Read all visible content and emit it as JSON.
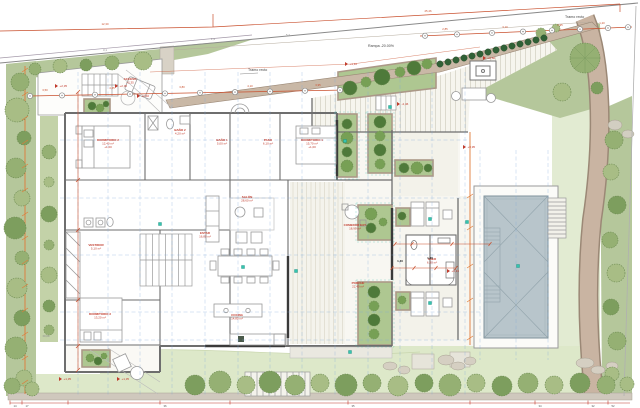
{
  "plan": {
    "annotations": {
      "tramo_recto_top": "Tramo recto",
      "tramo_recto_mid": "Tramo recto",
      "ramp": "Rampa -20.00%",
      "stair_note": "±0,00"
    },
    "colors": {
      "green": "#b5c79b",
      "green_light": "#c3d2a8",
      "lawn": "#dde8c9",
      "lawn_light": "#e2ebd2",
      "pool_water": "#b8c5cb",
      "path_tan": "#c9b4a2",
      "wall_tan": "#c9b8a6",
      "dim_red": "#c9502e",
      "dim_orange": "#e07b39",
      "axis_blue": "#7fa8d8",
      "teal": "#35c4b0",
      "tree_dark": "#4e7a3a",
      "wall_gray": "#6e6e6e"
    },
    "room_labels": [
      {
        "x": 108,
        "y": 141,
        "lines": [
          "DORMITORIO 2",
          "12,40 m²",
          "+1,00"
        ]
      },
      {
        "x": 180,
        "y": 131,
        "lines": [
          "BAÑO 2",
          "4,20 m²"
        ]
      },
      {
        "x": 222,
        "y": 141,
        "lines": [
          "BAÑO 1",
          "5,00 m²"
        ]
      },
      {
        "x": 268,
        "y": 141,
        "lines": [
          "PASO",
          "6,10 m²"
        ]
      },
      {
        "x": 312,
        "y": 141,
        "lines": [
          "DORMITORIO 1",
          "15,70 m²",
          "+1,00"
        ]
      },
      {
        "x": 96,
        "y": 246,
        "lines": [
          "VESTIDOR",
          "5,10 m²"
        ]
      },
      {
        "x": 100,
        "y": 315,
        "lines": [
          "DORMITORIO 3",
          "13,20 m²"
        ]
      },
      {
        "x": 247,
        "y": 198,
        "lines": [
          "SALÓN",
          "28,60 m²"
        ]
      },
      {
        "x": 205,
        "y": 234,
        "lines": [
          "ESTAR",
          "16,80 m²"
        ]
      },
      {
        "x": 237,
        "y": 316,
        "lines": [
          "COCINA",
          "14,80 m²"
        ]
      },
      {
        "x": 355,
        "y": 226,
        "lines": [
          "COMEDOR EXT.",
          "18,90 m²"
        ]
      },
      {
        "x": 358,
        "y": 284,
        "lines": [
          "PORCHE",
          "22,40 m²"
        ]
      },
      {
        "x": 432,
        "y": 260,
        "lines": [
          "ASEO",
          "6,30 m²"
        ]
      },
      {
        "x": 130,
        "y": 80,
        "lines": [
          "ACCESO",
          "+2,35"
        ]
      }
    ],
    "level_markers": [
      {
        "x": 58,
        "y": 86,
        "text": "+2,35"
      },
      {
        "x": 118,
        "y": 86,
        "text": "+2,35"
      },
      {
        "x": 140,
        "y": 96,
        "text": "+2,40"
      },
      {
        "x": 348,
        "y": 64,
        "text": "+1,10"
      },
      {
        "x": 400,
        "y": 104,
        "text": "-2,46"
      },
      {
        "x": 62,
        "y": 379,
        "text": "+1,35"
      },
      {
        "x": 120,
        "y": 379,
        "text": "+1,35"
      },
      {
        "x": 450,
        "y": 271,
        "text": "+0,15"
      },
      {
        "x": 466,
        "y": 147,
        "text": "+0,95"
      },
      {
        "x": 486,
        "y": 58,
        "text": "+0,60"
      }
    ],
    "dim_labels": {
      "red": [
        {
          "x": 428,
          "y": 12,
          "t": "25,46"
        },
        {
          "x": 105,
          "y": 25,
          "t": "12,30"
        },
        {
          "x": 45,
          "y": 91,
          "t": "3,50"
        },
        {
          "x": 112,
          "y": 89,
          "t": "4,25"
        },
        {
          "x": 182,
          "y": 88,
          "t": "3,80"
        },
        {
          "x": 250,
          "y": 87,
          "t": "4,10"
        },
        {
          "x": 318,
          "y": 86,
          "t": "3,95"
        },
        {
          "x": 445,
          "y": 30,
          "t": "2,85"
        },
        {
          "x": 505,
          "y": 28,
          "t": "3,10"
        },
        {
          "x": 560,
          "y": 26,
          "t": "2,95"
        },
        {
          "x": 602,
          "y": 24,
          "t": "1,20"
        }
      ],
      "black": [
        {
          "x": 400,
          "y": 262,
          "t": "1,40"
        },
        {
          "x": 430,
          "y": 259,
          "t": "1,20"
        }
      ],
      "gray": [
        {
          "x": 213,
          "y": 40,
          "t": "1,4"
        },
        {
          "x": 288,
          "y": 36,
          "t": "5,2"
        },
        {
          "x": 105,
          "y": 51,
          "t": "3,1"
        }
      ]
    },
    "bottom_scale": [
      {
        "x": 10,
        "t": "14"
      },
      {
        "x": 22,
        "t": "17"
      },
      {
        "x": 160,
        "t": "36"
      },
      {
        "x": 348,
        "t": "35"
      },
      {
        "x": 535,
        "t": "34"
      },
      {
        "x": 588,
        "t": "32"
      },
      {
        "x": 608,
        "t": "52"
      }
    ],
    "trees": {
      "left_strip": [
        [
          20,
          82,
          9
        ],
        [
          17,
          110,
          12
        ],
        [
          24,
          138,
          7
        ],
        [
          16,
          168,
          10
        ],
        [
          22,
          198,
          8
        ],
        [
          15,
          228,
          11
        ],
        [
          22,
          258,
          7
        ],
        [
          17,
          288,
          10
        ],
        [
          22,
          318,
          8
        ],
        [
          16,
          348,
          11
        ],
        [
          24,
          378,
          8
        ]
      ],
      "narrow_strip": [
        [
          49,
          152,
          7
        ],
        [
          49,
          182,
          5
        ],
        [
          49,
          214,
          8
        ],
        [
          49,
          245,
          5
        ],
        [
          49,
          275,
          8
        ],
        [
          49,
          306,
          6
        ],
        [
          49,
          330,
          5
        ]
      ],
      "top_band": [
        [
          35,
          69,
          6
        ],
        [
          60,
          66,
          7
        ],
        [
          86,
          65,
          6
        ],
        [
          112,
          63,
          7
        ],
        [
          143,
          61,
          9
        ]
      ],
      "upper_planter": [
        [
          350,
          88,
          7
        ],
        [
          366,
          82,
          5
        ],
        [
          382,
          77,
          8
        ],
        [
          400,
          72,
          5
        ],
        [
          414,
          68,
          7
        ],
        [
          427,
          64,
          5
        ]
      ],
      "garden": [
        [
          585,
          58,
          15
        ],
        [
          562,
          92,
          9
        ],
        [
          597,
          88,
          6
        ],
        [
          541,
          33,
          5
        ],
        [
          556,
          28,
          4
        ]
      ],
      "right_slope": [
        [
          614,
          140,
          9
        ],
        [
          611,
          172,
          8
        ],
        [
          617,
          205,
          9
        ],
        [
          610,
          240,
          8
        ],
        [
          616,
          273,
          9
        ],
        [
          611,
          307,
          8
        ],
        [
          617,
          341,
          9
        ],
        [
          612,
          374,
          7
        ]
      ],
      "bottom_row": [
        [
          12,
          386,
          8
        ],
        [
          32,
          389,
          7
        ],
        [
          195,
          385,
          10
        ],
        [
          220,
          382,
          11
        ],
        [
          246,
          385,
          9
        ],
        [
          270,
          382,
          11
        ],
        [
          295,
          385,
          10
        ],
        [
          320,
          383,
          9
        ],
        [
          346,
          385,
          11
        ],
        [
          372,
          383,
          9
        ],
        [
          398,
          386,
          10
        ],
        [
          424,
          383,
          9
        ],
        [
          450,
          385,
          11
        ],
        [
          476,
          383,
          9
        ],
        [
          502,
          386,
          10
        ],
        [
          528,
          383,
          10
        ],
        [
          554,
          385,
          9
        ],
        [
          580,
          383,
          10
        ],
        [
          606,
          385,
          9
        ],
        [
          627,
          384,
          7
        ]
      ],
      "spine": [
        [
          347,
          124,
          5
        ],
        [
          347,
          138,
          6
        ],
        [
          347,
          152,
          5
        ],
        [
          347,
          166,
          6
        ],
        [
          380,
          122,
          6
        ],
        [
          380,
          136,
          5
        ],
        [
          380,
          150,
          6
        ],
        [
          380,
          164,
          5
        ],
        [
          404,
          168,
          5
        ],
        [
          417,
          168,
          6
        ],
        [
          428,
          168,
          4
        ],
        [
          371,
          214,
          6
        ],
        [
          371,
          228,
          5
        ],
        [
          383,
          222,
          4
        ],
        [
          374,
          292,
          6
        ],
        [
          374,
          306,
          5
        ],
        [
          374,
          320,
          6
        ],
        [
          374,
          334,
          5
        ]
      ],
      "small_planters": [
        [
          92,
          106,
          4
        ],
        [
          100,
          108,
          4
        ],
        [
          106,
          104,
          3
        ],
        [
          90,
          358,
          4
        ],
        [
          98,
          361,
          4
        ],
        [
          104,
          356,
          3
        ],
        [
          402,
          216,
          4
        ],
        [
          402,
          300,
          4
        ]
      ],
      "bush_row": [
        [
          440,
          64
        ],
        [
          448,
          62
        ],
        [
          456,
          60
        ],
        [
          464,
          58
        ],
        [
          472,
          56
        ],
        [
          480,
          54
        ],
        [
          488,
          52
        ],
        [
          496,
          50
        ],
        [
          504,
          48
        ],
        [
          512,
          46
        ],
        [
          520,
          44
        ],
        [
          528,
          42
        ],
        [
          536,
          40
        ],
        [
          544,
          38
        ]
      ]
    },
    "teal_dots": [
      [
        160,
        224
      ],
      [
        243,
        267
      ],
      [
        296,
        271
      ],
      [
        345,
        141
      ],
      [
        390,
        107
      ],
      [
        430,
        219
      ],
      [
        430,
        303
      ],
      [
        518,
        266
      ],
      [
        350,
        352
      ],
      [
        467,
        222
      ]
    ]
  }
}
